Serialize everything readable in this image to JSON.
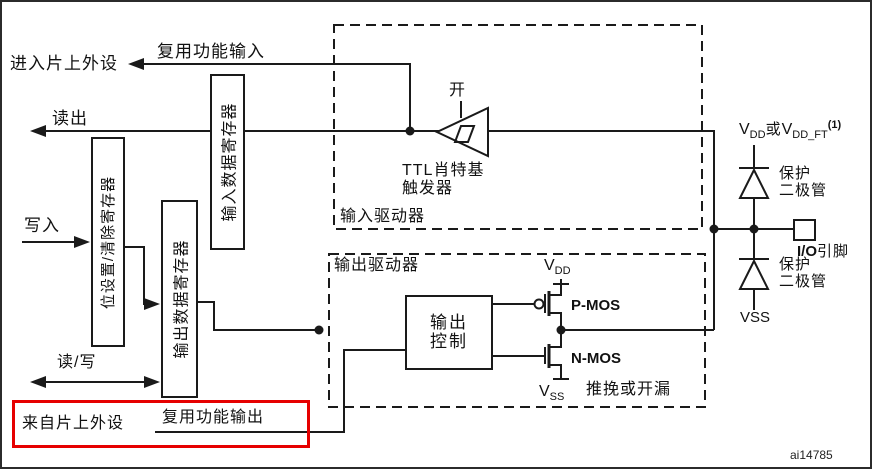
{
  "figure": {
    "code": "ai14785",
    "colors": {
      "line": "#1a1a1a",
      "highlight_red": "#e60000"
    },
    "left": {
      "to_onchip_peripheral": "进入片上外设",
      "af_input": "复用功能输入",
      "read": "读出",
      "write": "写入",
      "read_write": "读/写",
      "from_onchip_peripheral": "来自片上外设",
      "af_output": "复用功能输出"
    },
    "registers": {
      "bit_set_clear": "位设置/清除寄存器",
      "output_data": "输出数据寄存器",
      "input_data": "输入数据寄存器"
    },
    "input_driver": {
      "box_label": "输入驱动器",
      "on": "开",
      "schmitt_line1": "TTL肖特基",
      "schmitt_line2": "触发器"
    },
    "output_driver": {
      "box_label": "输出驱动器",
      "control_line1": "输出",
      "control_line2": "控制",
      "vdd_v": "V",
      "vdd_sub": "DD",
      "vss_v": "V",
      "vss_sub": "SS",
      "pmos": "P-MOS",
      "nmos": "N-MOS",
      "push_pull_open_drain": "推挽或开漏"
    },
    "right": {
      "v1": "V",
      "v1_sub": "DD",
      "or": "或",
      "v2": "V",
      "v2_sub": "DD_FT",
      "note_sup": "(1)",
      "prot_diode_l1": "保护",
      "prot_diode_l2": "二极管",
      "vss": "VSS",
      "io_bold": "I/O",
      "io_pin": "引脚"
    }
  }
}
